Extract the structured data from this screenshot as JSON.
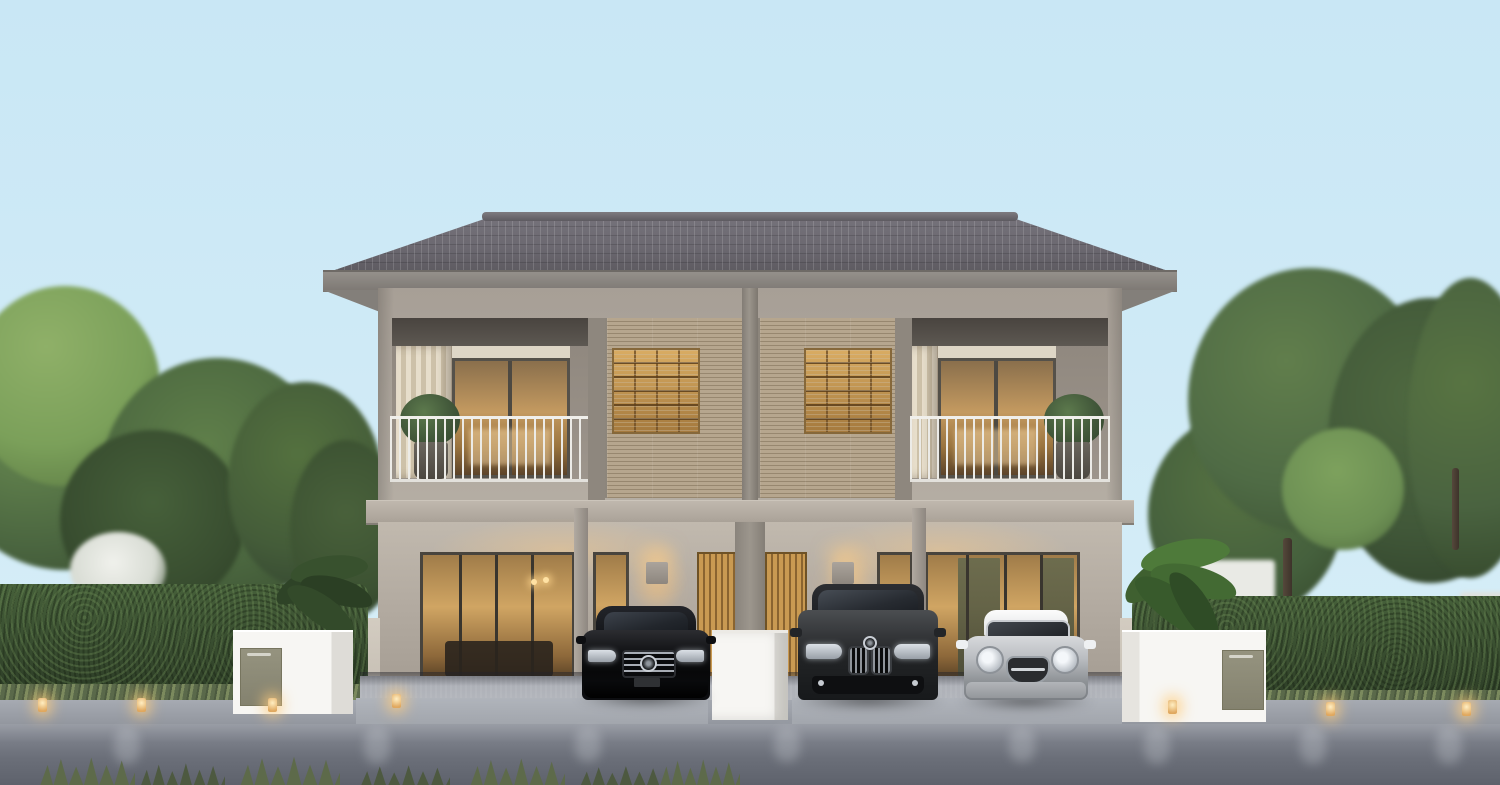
{
  "scene": {
    "description": "Dusk 3D architectural rendering of a modern two-storey twin duplex house with carports, three cars parked in front, flanked by green trees and trimmed hedges",
    "time_of_day": "dusk",
    "sky": "clear pale blue"
  },
  "house": {
    "label": "Modern two-storey twin duplex, grey hip tiled roof, two mirrored units",
    "units": 2,
    "upper_floor": {
      "left_balcony": "recessed balcony, white bar railing, sliding glass door with warm light, striped cream curtain, potted shrub",
      "screens": "tan horizontal-slat screen panels with warm-lit wooden shelving windows behind",
      "right_balcony": "mirrored recessed balcony with potted shrub on right"
    },
    "ground_floor": {
      "left_unit": "full-height glass sliding doors with warm-lit living room, narrow amber window, wall sconce, amber wooden slat door",
      "right_unit": "amber wooden slat door, wall sconce, narrow amber window, glass sliding doors with olive curtains",
      "carport": "open double carport under upper floor"
    }
  },
  "vehicles": [
    {
      "label": "black Mercedes-Benz sedan parked in left carport",
      "color": "#0b0c0e"
    },
    {
      "label": "dark grey BMW SUV parked in right carport left bay",
      "color": "#2c2f31"
    },
    {
      "label": "silver Mini Cooper with white roof parked in right carport right bay",
      "color": "#b6b9bd"
    }
  ],
  "landscape": {
    "left": "tall green trees, white flowering bush, trimmed hedge wall, broadleaf shrubs, lawn lights",
    "right": "tall green trees with visible trunks, trimmed hedge wall, large banana-leaf plant, lawn lights",
    "foreground": "paved sidewalk, asphalt road with warm light reflections, grass tufts along bottom edge"
  },
  "street_furniture": {
    "left_pillar": "white masonry gate pillar with grey mailbox panel",
    "center_box": "white gate box between the two driveways",
    "right_pillar": "white masonry gate pillar with grey mailbox panel",
    "lawn_lights_count": 7
  },
  "palette": {
    "sky": "#cfeaf6",
    "roof": "#625f65",
    "fascia": "#8a8580",
    "wall_upper": "#a89f96",
    "wall_lower": "#b3aba1",
    "screen_tan": "#ad9d85",
    "warm_light": "#d8a65f",
    "railing_white": "#eceae6",
    "hedge_green": "#3d5033",
    "tree_green": "#4c6741",
    "road_grey": "#696d77",
    "sidewalk_grey": "#9b9fa7",
    "pillar_white": "#f5f4f1",
    "mailbox_panel": "#8d8b7d",
    "car_black": "#0b0c0e",
    "car_suv_grey": "#2c2f31",
    "car_silver": "#b6b9bd"
  }
}
